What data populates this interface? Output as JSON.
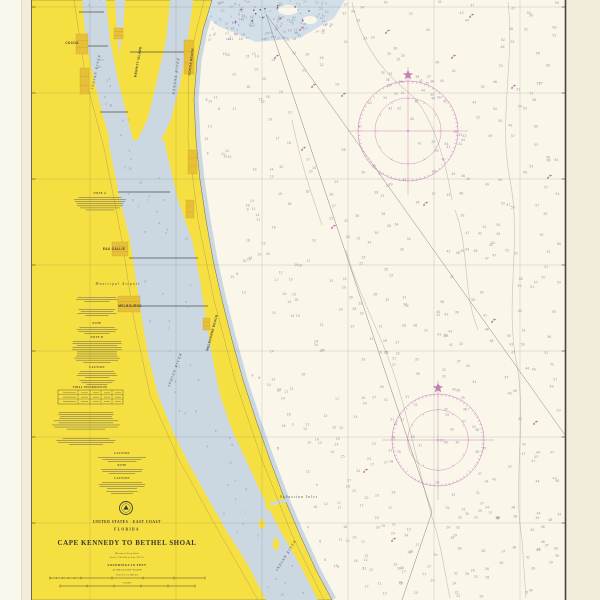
{
  "chart": {
    "header": {
      "region_line": "UNITED STATES · EAST COAST",
      "state": "FLORIDA",
      "title": "CAPE KENNEDY TO BETHEL SHOAL",
      "projection": "Mercator Projection",
      "scale": "Scale 1:80,000 at Lat. 28°15'",
      "soundings_unit": "SOUNDINGS IN FEET",
      "datum": "AT MEAN LOW WATER",
      "bar1_label": "NAUTICAL MILES",
      "bar2_label": "YARDS"
    },
    "tide_table_title": "TIDAL INFORMATION",
    "notes_blocks": [
      {
        "heading": "NOTE A",
        "cx": 100,
        "top": 192,
        "lines": 7,
        "width": 52
      },
      {
        "heading": "",
        "cx": 97,
        "top": 297,
        "lines": 3,
        "width": 46
      },
      {
        "heading": "",
        "cx": 97,
        "top": 309,
        "lines": 4,
        "width": 42
      },
      {
        "heading": "NOTE",
        "cx": 97,
        "top": 322,
        "lines": 4,
        "width": 46
      },
      {
        "heading": "NOTE B",
        "cx": 97,
        "top": 336,
        "lines": 11,
        "width": 50
      },
      {
        "heading": "CAUTION",
        "cx": 97,
        "top": 366,
        "lines": 4,
        "width": 44
      },
      {
        "heading": "",
        "cx": 97,
        "top": 380,
        "lines": 3,
        "width": 38
      },
      {
        "heading": "",
        "cx": 86,
        "top": 412,
        "lines": 9,
        "width": 70
      },
      {
        "heading": "",
        "cx": 86,
        "top": 438,
        "lines": 4,
        "width": 62
      },
      {
        "heading": "CAUTION",
        "cx": 122,
        "top": 452,
        "lines": 3,
        "width": 52
      },
      {
        "heading": "NOTE",
        "cx": 122,
        "top": 464,
        "lines": 3,
        "width": 48
      },
      {
        "heading": "CAUTION",
        "cx": 122,
        "top": 477,
        "lines": 4,
        "width": 54
      },
      {
        "heading": "",
        "cx": 122,
        "top": 491,
        "lines": 2,
        "width": 40
      }
    ],
    "place_labels": [
      {
        "text": "COCOA",
        "x": 72,
        "y": 44,
        "rot": 0,
        "size": 3.2,
        "cls": "t-town"
      },
      {
        "text": "COCOA BEACH",
        "x": 192,
        "y": 62,
        "rot": -83,
        "size": 2.8,
        "cls": "t-town"
      },
      {
        "text": "MERRITT ISLAND",
        "x": 139,
        "y": 62,
        "rot": -80,
        "size": 3.0,
        "cls": "t-town"
      },
      {
        "text": "BANANA RIVER",
        "x": 177,
        "y": 76,
        "rot": -82,
        "size": 3.2,
        "cls": "t-water"
      },
      {
        "text": "INDIAN RIVER",
        "x": 97,
        "y": 72,
        "rot": -78,
        "size": 3.2,
        "cls": "t-water"
      },
      {
        "text": "INDIAN RIVER",
        "x": 176,
        "y": 370,
        "rot": -70,
        "size": 3.8,
        "cls": "t-water"
      },
      {
        "text": "INDIAN RIVER",
        "x": 287,
        "y": 556,
        "rot": -58,
        "size": 3.8,
        "cls": "t-water"
      },
      {
        "text": "EAU GALLIE",
        "x": 114,
        "y": 250,
        "rot": 0,
        "size": 3.0,
        "cls": "t-town"
      },
      {
        "text": "MELBOURNE",
        "x": 130,
        "y": 307,
        "rot": 0,
        "size": 3.2,
        "cls": "t-town"
      },
      {
        "text": "Municipal Airport",
        "x": 118,
        "y": 285,
        "rot": 0,
        "size": 2.5,
        "cls": "t-water"
      },
      {
        "text": "MELBOURNE BEACH",
        "x": 213,
        "y": 333,
        "rot": -75,
        "size": 2.6,
        "cls": "t-town"
      },
      {
        "text": "Sebastian Inlet",
        "x": 299,
        "y": 498,
        "rot": 0,
        "size": 2.7,
        "cls": "t-water"
      }
    ],
    "urban_areas": [
      {
        "x": 76,
        "y": 34,
        "w": 12,
        "h": 20
      },
      {
        "x": 184,
        "y": 40,
        "w": 10,
        "h": 34
      },
      {
        "x": 114,
        "y": 28,
        "w": 9,
        "h": 11
      },
      {
        "x": 80,
        "y": 68,
        "w": 9,
        "h": 26
      },
      {
        "x": 188,
        "y": 150,
        "w": 9,
        "h": 24
      },
      {
        "x": 186,
        "y": 200,
        "w": 8,
        "h": 18
      },
      {
        "x": 112,
        "y": 242,
        "w": 16,
        "h": 14
      },
      {
        "x": 118,
        "y": 296,
        "w": 22,
        "h": 16
      },
      {
        "x": 203,
        "y": 318,
        "w": 7,
        "h": 12
      }
    ],
    "buoys": [
      [
        300,
        30
      ],
      [
        386,
        33
      ],
      [
        342,
        96
      ],
      [
        452,
        58
      ],
      [
        512,
        88
      ],
      [
        470,
        17
      ],
      [
        548,
        178
      ],
      [
        332,
        228
      ],
      [
        302,
        150
      ],
      [
        424,
        205
      ],
      [
        492,
        322
      ],
      [
        534,
        424
      ],
      [
        364,
        472
      ],
      [
        392,
        541
      ],
      [
        312,
        87
      ],
      [
        275,
        58
      ]
    ],
    "compass_roses": [
      {
        "cx": 408,
        "cy": 131,
        "r": 50
      },
      {
        "cx": 438,
        "cy": 440,
        "r": 46
      }
    ],
    "colors": {
      "land": "#f6e041",
      "urban": "#e7c035",
      "lagoon": "#cbd7e1",
      "shoal": "#d2dfe9",
      "ocean": "#faf6ea",
      "margin": "#f1edda",
      "margin_light": "#f9f7ee",
      "ink": "#45413a",
      "contour": "#cfc8b6",
      "sounding": "#8f8aa0",
      "magenta": "#b560a8"
    },
    "soundings": {
      "seed": 11,
      "ocean_count": 520,
      "shoal_count": 130,
      "lagoon_count": 70
    }
  }
}
